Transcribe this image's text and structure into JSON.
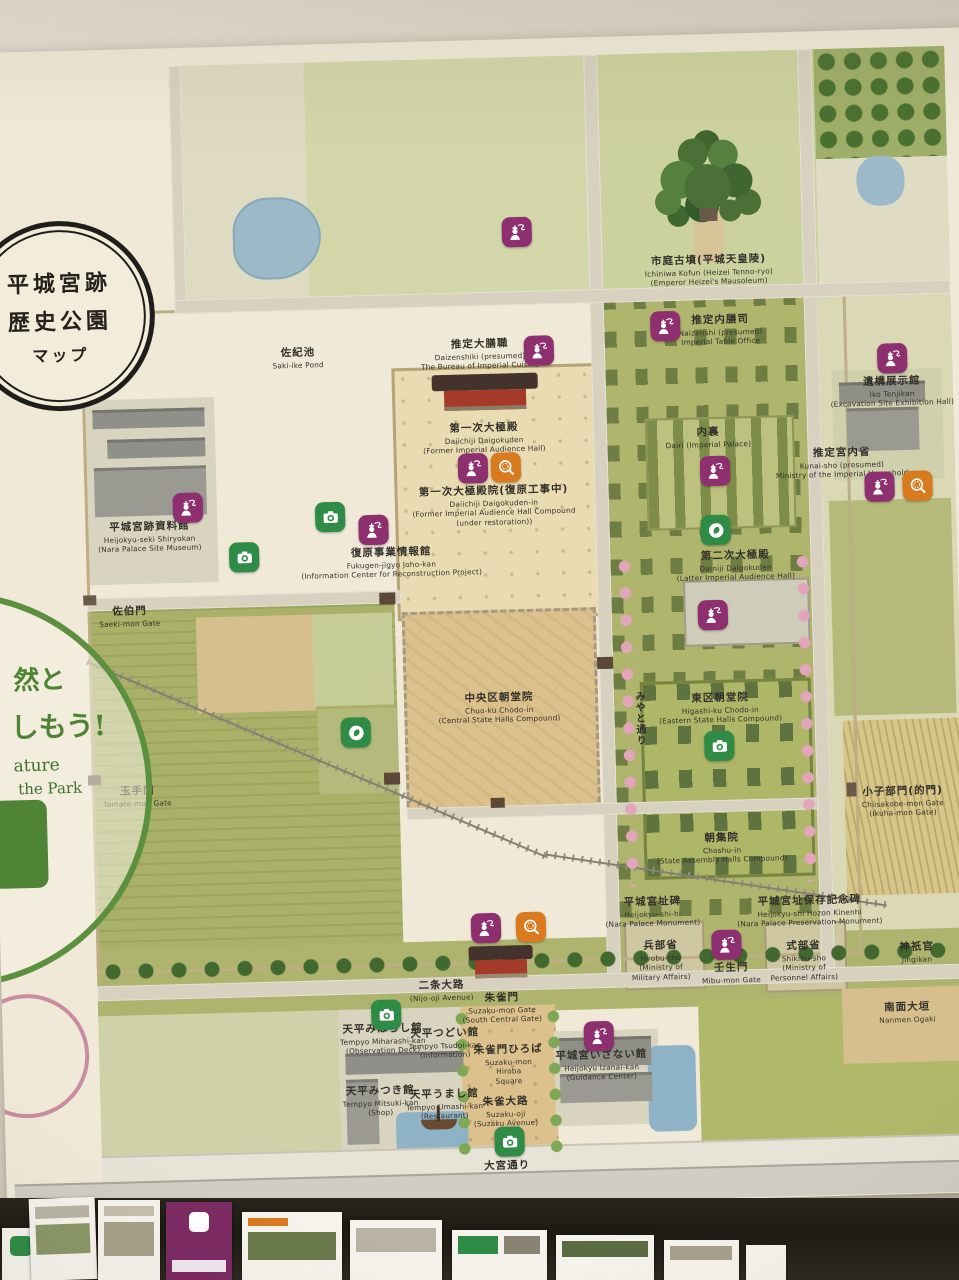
{
  "title_sign": {
    "lines": [
      "平城宮跡",
      "歴史公園",
      "マップ"
    ]
  },
  "nature_sign": {
    "lines": [
      "然と",
      "しもう!",
      "ature",
      "the Park"
    ]
  },
  "map": {
    "labels": [
      {
        "lines": [
          "佐紀池",
          "Saki-ike Pond"
        ]
      },
      {
        "lines": [
          "市庭古墳(平城天皇陵)",
          "Ichiniwa Kofun (Heizei Tenno-ryo)",
          "(Emperor Heizei's Mausoleum)"
        ]
      },
      {
        "lines": [
          "推定大膳職",
          "Daizenshiki (presumed)",
          "The Bureau of Imperial Cuisine"
        ]
      },
      {
        "lines": [
          "推定内膳司",
          "Naizenshi (presumed)",
          "Imperial Table Office"
        ]
      },
      {
        "lines": [
          "第一次大極殿",
          "Daiichiji Daigokuden",
          "(Former Imperial Audience Hall)"
        ]
      },
      {
        "lines": [
          "第一次大極殿院(復原工事中)",
          "Daiichiji Daigokuden-in",
          "(Former Imperial Audience Hall Compound",
          "(under restoration))"
        ]
      },
      {
        "lines": [
          "復原事業情報館",
          "Fukugen-jigyo Joho-kan",
          "(Information Center for Reconstruction Project)"
        ]
      },
      {
        "lines": [
          "遺構展示館",
          "Iko Tenjikan",
          "(Excavation Site Exhibition Hall)"
        ]
      },
      {
        "lines": [
          "推定宮内省",
          "Kunai-sho (presumed)",
          "Ministry of the Imperial Household"
        ]
      },
      {
        "lines": [
          "内裏",
          "Dairi (Imperial Palace)"
        ]
      },
      {
        "lines": [
          "第二次大極殿",
          "Dainiji Daigokuden",
          "(Latter Imperial Audience Hall)"
        ]
      },
      {
        "lines": [
          "中央区朝堂院",
          "Chuo-ku Chodo-in",
          "(Central State Halls Compound)"
        ]
      },
      {
        "lines": [
          "東区朝堂院",
          "Higashi-ku Chodo-in",
          "(Eastern State Halls Compound)"
        ]
      },
      {
        "lines": [
          "朝集院",
          "Choshu-in",
          "(State Assembly Halls Compound)"
        ]
      },
      {
        "lines": [
          "平城宮跡資料館",
          "Heijokyu-seki Shiryokan",
          "(Nara Palace Site Museum)"
        ]
      },
      {
        "lines": [
          "佐伯門",
          "Saeki-mon Gate"
        ]
      },
      {
        "lines": [
          "玉手門",
          "Tamate-mon Gate"
        ]
      },
      {
        "lines": [
          "小子部門(的門)",
          "Chiisakobe-mon Gate",
          "(Ikuha-mon Gate)"
        ]
      },
      {
        "lines": [
          "みやと通り"
        ]
      },
      {
        "lines": [
          "平城宮址碑",
          "Heijokyu-shi-hi",
          "(Nara Palace Monument)"
        ]
      },
      {
        "lines": [
          "平城宮址保存記念碑",
          "Heijokyu-shi Hozon Kinenhi",
          "(Nara Palace Preservation Monument)"
        ]
      },
      {
        "lines": [
          "兵部省",
          "Hyobu-sho",
          "(Ministry of",
          "Military Affairs)"
        ]
      },
      {
        "lines": [
          "壬生門",
          "Mibu-mon Gate"
        ]
      },
      {
        "lines": [
          "式部省",
          "Shikibu-sho",
          "(Ministry of",
          "Personnel Affairs)"
        ]
      },
      {
        "lines": [
          "神祇官",
          "Jingikan"
        ]
      },
      {
        "lines": [
          "二条大路",
          "(Nijo-oji Avenue)"
        ]
      },
      {
        "lines": [
          "朱雀門",
          "Suzaku-mon Gate",
          "(South Central Gate)"
        ]
      },
      {
        "lines": [
          "天平みはらし館",
          "Tempyo Miharashi-kan",
          "(Observation Deck)"
        ]
      },
      {
        "lines": [
          "天平つどい館",
          "Tempyo Tsudoi-kan",
          "(Information)"
        ]
      },
      {
        "lines": [
          "天平みつき館",
          "Tempyo Mitsuki-kan",
          "(Shop)"
        ]
      },
      {
        "lines": [
          "天平うまし館",
          "Tempyo Umashi-kan",
          "(Restaurant)"
        ]
      },
      {
        "lines": [
          "朱雀門ひろば",
          "Suzaku-mon",
          "Hiroba",
          "Square"
        ]
      },
      {
        "lines": [
          "朱雀大路",
          "Suzaku-oji",
          "(Suzaku Avenue)"
        ]
      },
      {
        "lines": [
          "平城宮いざない館",
          "Heijokyu Izanai-kan",
          "(Guidance Center)"
        ]
      },
      {
        "lines": [
          "南面大垣",
          "Nanmen Ogaki"
        ]
      },
      {
        "lines": [
          "大宮通り",
          "Omiya-dori (Omiya Avenue)"
        ]
      }
    ]
  },
  "colors": {
    "badge_purple": "#8e2f6f",
    "badge_orange": "#d97a1f",
    "badge_green": "#2f8c46",
    "park_green": "#a9b168",
    "compound_tan": "#ddc18d",
    "pond_blue": "#9cb9c9",
    "road_gray": "#d8d1bf",
    "board_cream": "#f0e9d7",
    "ring_black": "#201e1b",
    "nature_green": "#5c8f3e"
  }
}
